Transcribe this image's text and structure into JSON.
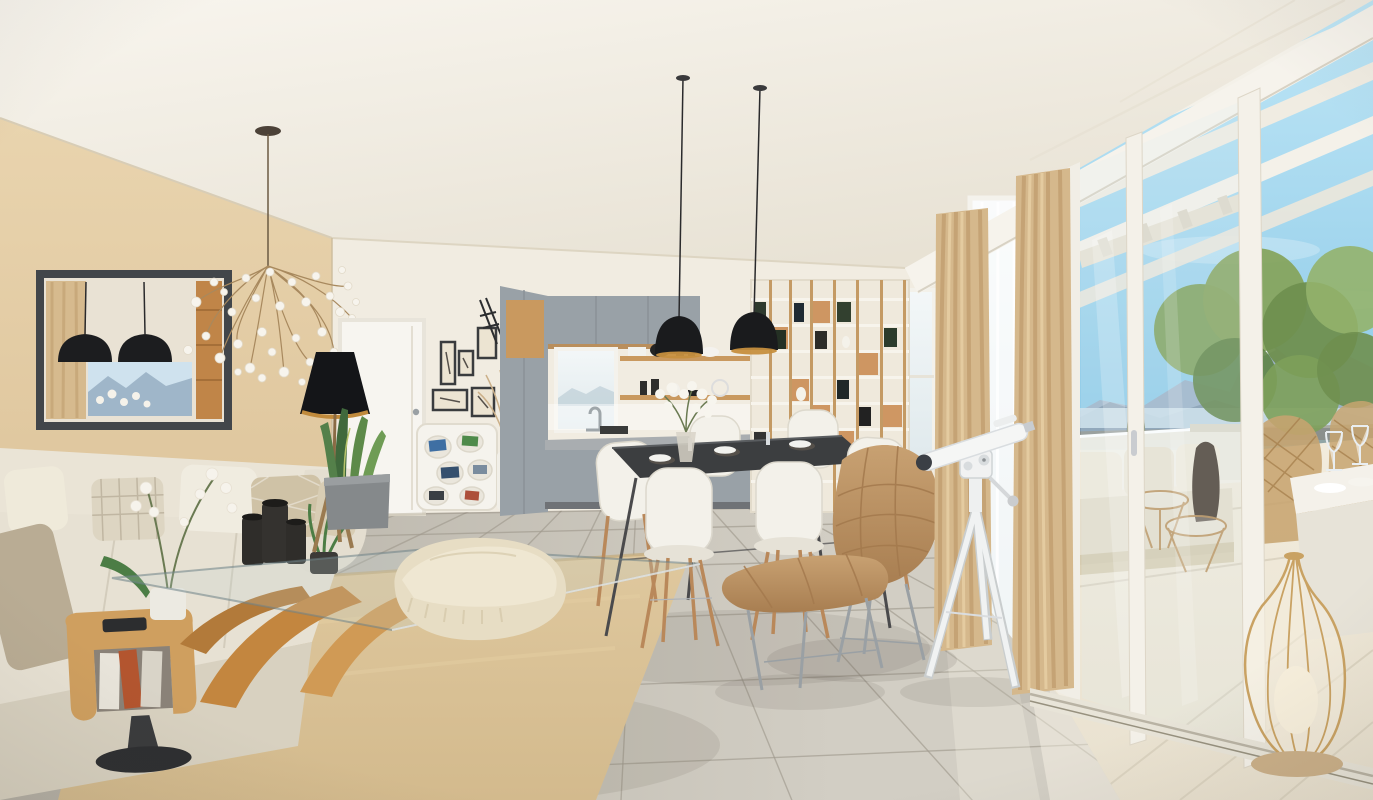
{
  "meta": {
    "type": "3d-interior-render",
    "room": "open-plan living, dining and kitchen with panoramic terrace",
    "style": "modern scandinavian new-build visualization",
    "width_px": 1373,
    "height_px": 800
  },
  "palette": {
    "wallWhite": "#f1ece1",
    "wallBeige": "#ddc49b",
    "cabinetGray": "#99a1a7",
    "wood": "#c9995f",
    "floorLight": "#d2cec4",
    "floorDark": "#b3aea3",
    "grout": "#a09a8e",
    "rug": "#d3ba8d",
    "sofa": "#e7e1d3",
    "curtain": "#d5b88c",
    "frameDark": "#42464a",
    "pendantBlack": "#1a1b1d",
    "brass": "#c68f3e",
    "skyTop": "#bfe6f6",
    "skyBottom": "#8bc9e7",
    "mountainFar": "#9cb3c8",
    "mountainNear": "#7e96ac",
    "snow": "#edf3f8",
    "lake": "#cfe2ec",
    "green": "#6f9150",
    "terraceFloor": "#e9e1cf",
    "leather": "#bf996a",
    "chairWhite": "#f3f1ea",
    "telescopeWhite": "#f2f3f2",
    "glassTint": "#dceef5"
  },
  "scene": {
    "objects": [
      {
        "name": "branch-chandelier",
        "label": "white petal branching chandelier"
      },
      {
        "name": "beige-accent-wall",
        "label": "beige painted accent wall"
      },
      {
        "name": "wall-mirror",
        "label": "dark framed rectangular mirror"
      },
      {
        "name": "cream-sofa",
        "label": "cream fabric sofa with throw pillows"
      },
      {
        "name": "magazine-side-table",
        "label": "bentwood magazine side table with black pedestal"
      },
      {
        "name": "glass-coffee-table",
        "label": "glass coffee table on sculptural wood base"
      },
      {
        "name": "black-candle-holders",
        "label": "black cylinder candle holders"
      },
      {
        "name": "white-orchid",
        "label": "white orchid in pot"
      },
      {
        "name": "shag-rug",
        "label": "tan shag area rug"
      },
      {
        "name": "floor-pouf",
        "label": "cream floor pouf with fringed throw"
      },
      {
        "name": "cone-floor-lamp",
        "label": "black cone floor lamp on wood tripod"
      },
      {
        "name": "snake-plant",
        "label": "snake plant in gray planter"
      },
      {
        "name": "white-door",
        "label": "white interior door"
      },
      {
        "name": "gallery-frames",
        "label": "gallery wall of small framed prints"
      },
      {
        "name": "cubby-shelf",
        "label": "white organic cubby shelf with books"
      },
      {
        "name": "dried-grass-vase",
        "label": "white vase with dried grasses"
      },
      {
        "name": "kitchen",
        "label": "gray and wood kitchen with window"
      },
      {
        "name": "open-shelves",
        "label": "wood open shelves with dishware"
      },
      {
        "name": "dome-pendants",
        "label": "two black dome pendant lamps with brass interior"
      },
      {
        "name": "dining-table",
        "label": "dark top dining table"
      },
      {
        "name": "dining-chairs",
        "label": "white shell chairs with wood dowel legs"
      },
      {
        "name": "flower-centerpiece",
        "label": "white flower centerpiece"
      },
      {
        "name": "tall-bookshelf",
        "label": "tall wood and white bookshelf"
      },
      {
        "name": "lounge-chair",
        "label": "quilted tan leather lounge chair"
      },
      {
        "name": "ottoman",
        "label": "quilted tan leather ottoman"
      },
      {
        "name": "telescope",
        "label": "white telescope on tripod"
      },
      {
        "name": "beige-curtains",
        "label": "floor length beige curtains"
      },
      {
        "name": "window-wall",
        "label": "floor to ceiling window wall"
      },
      {
        "name": "sliding-glass-door",
        "label": "white sliding glass door to terrace"
      },
      {
        "name": "pergola",
        "label": "white pergola beams over terrace"
      },
      {
        "name": "mountain-view",
        "label": "snow capped mountain panorama"
      },
      {
        "name": "lake",
        "label": "lake in the valley"
      },
      {
        "name": "terrace-railing",
        "label": "white terrace parapet railing"
      },
      {
        "name": "terrace-plants",
        "label": "green terrace planters"
      },
      {
        "name": "outdoor-sofa",
        "label": "outdoor sofa with cushions"
      },
      {
        "name": "wicker-chairs",
        "label": "bronze wicker outdoor chairs"
      },
      {
        "name": "outdoor-table",
        "label": "white outdoor dining table with glasses"
      },
      {
        "name": "wire-lantern",
        "label": "gold wire teardrop lantern"
      },
      {
        "name": "tile-floor",
        "label": "large light gray floor tiles"
      },
      {
        "name": "terrace-floor",
        "label": "cream stone terrace floor"
      }
    ]
  }
}
